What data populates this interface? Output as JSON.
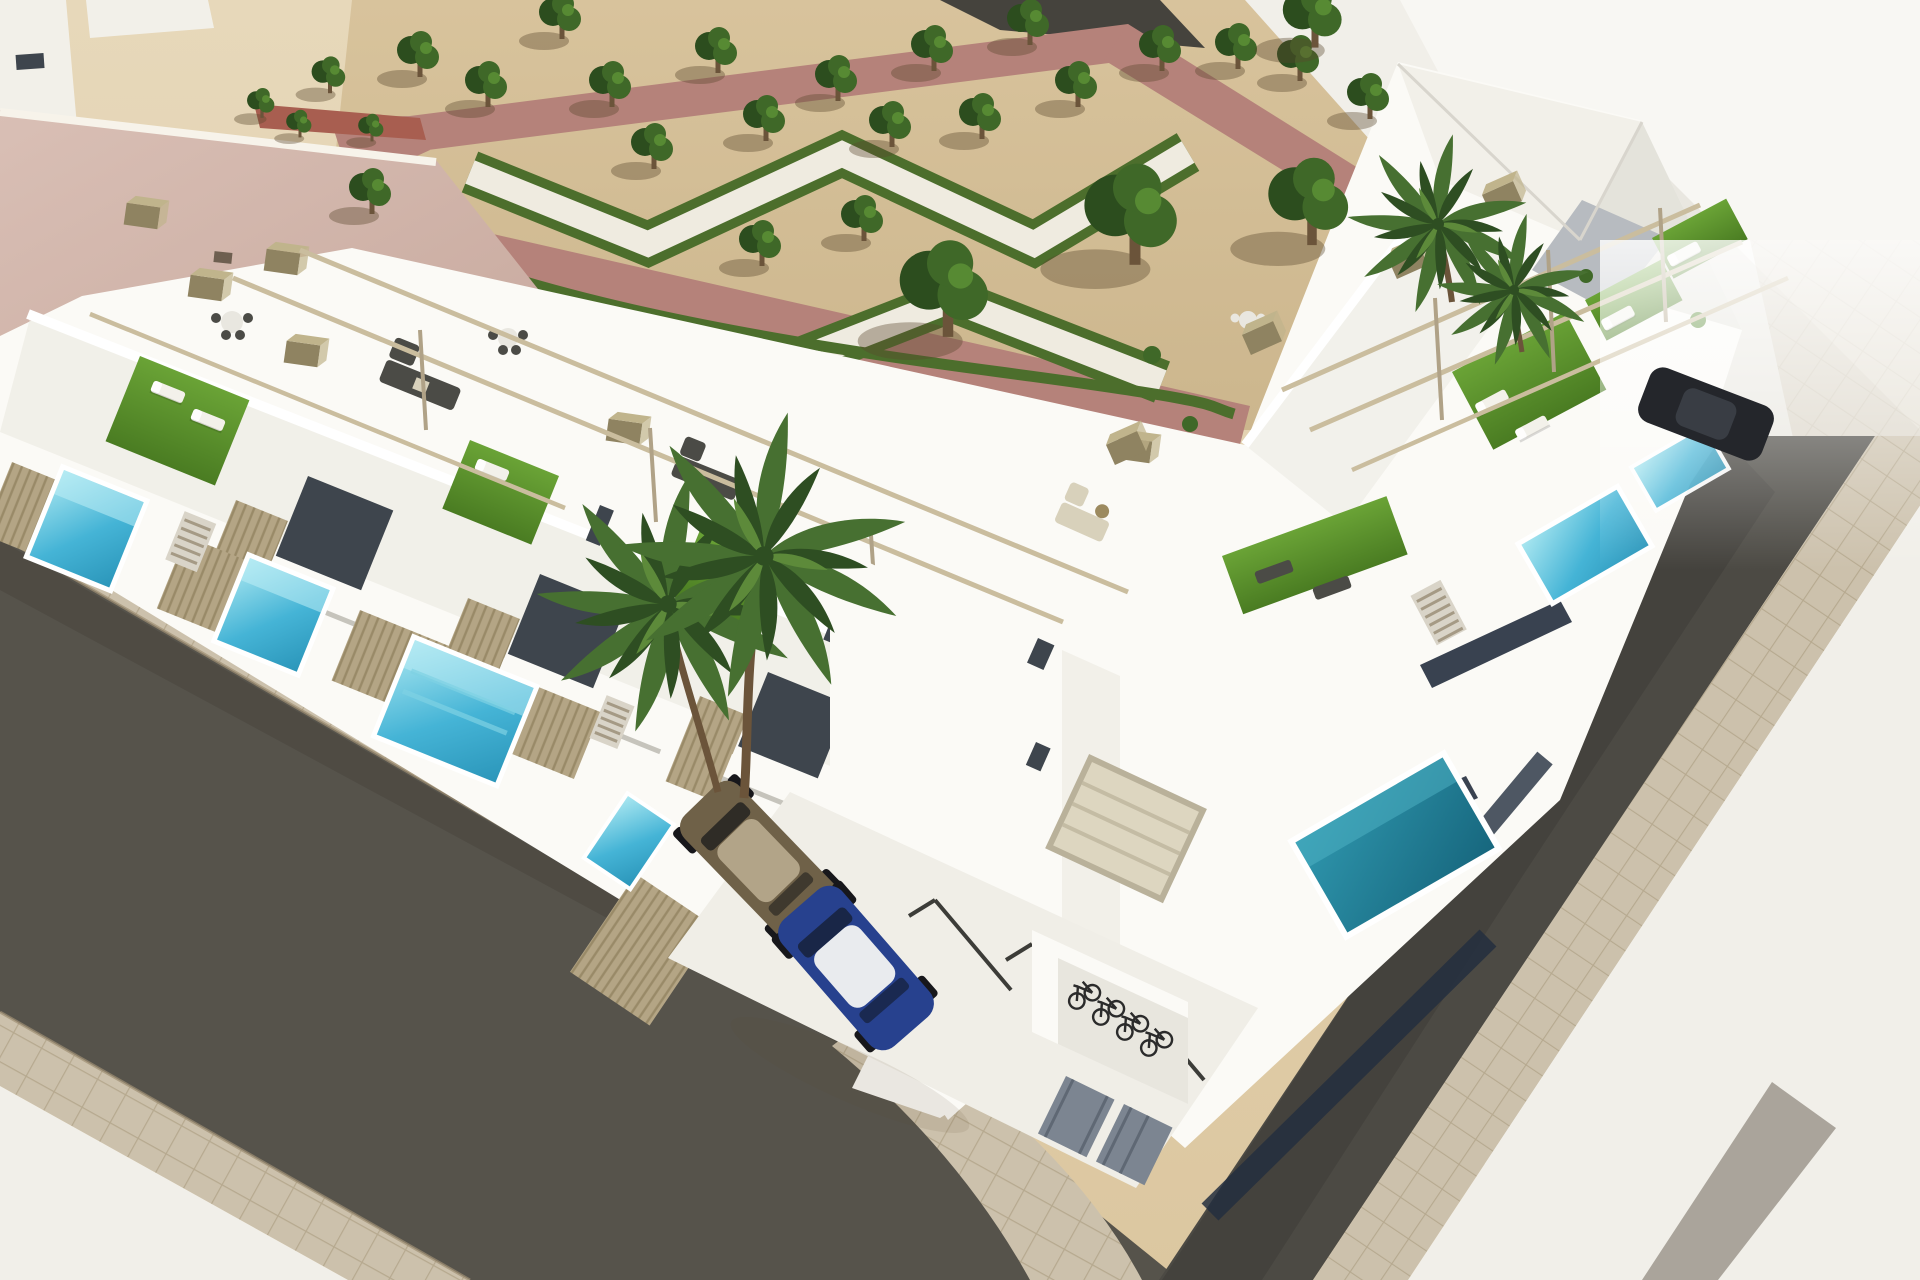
{
  "scene": {
    "title": "Aerial 3D architectural render — modern white corner townhouse development with roof terraces, plunge pools and landscaped park",
    "description": "Bird's-eye visualization of a new-build residential block on a street corner: two rows of white two-storey townhouses with artificial-turf roof terraces, pergola frames and private plunge pools; a sandy public park with clipped zigzag hedges, terracotta walking paths and trees behind; dark asphalt streets with square-slab sidewalks in front; a parking court with two cars, a bicycle shelter with four bikes, and palm trees by the entrance.",
    "setting": "midday sun from the upper right, shadows falling to the lower left",
    "render_style": "photoreal CGI, no text or UI elements visible"
  },
  "palette": {
    "sand": "#e7d8ba",
    "sand_deep": "#dcc7a0",
    "gravel": "#d8c39c",
    "gravel_deep": "#ccb68d",
    "plaza_white": "#f1efe9",
    "plaza_bright": "#f8f7f3",
    "plaza_shadow": "#e5e2db",
    "path_white": "#efebe0",
    "path_red": "#b5827a",
    "path_red_dark": "#a06b62",
    "hedge": "#4c6e2c",
    "hedge_dark": "#3c5a23",
    "tree_dark": "#2c4d1e",
    "tree_mid": "#3f6828",
    "tree_light": "#578a33",
    "trunk": "#6b543a",
    "shadow": "rgba(90,72,45,0.38)",
    "white_wall": "#fbfaf6",
    "white_wall_2": "#f2f0e9",
    "wall_shade": "#dfddd4",
    "wall_dark": "#c6c4bc",
    "terrace_floor": "#e9e7df",
    "roof_pink": "#d9bfb5",
    "roof_pink_dark": "#c7a89d",
    "roof_red": "#a85e50",
    "glass_dark": "#3e454d",
    "navy_glass": "#232e3e",
    "slat_wood": "#b4a585",
    "slat_wood_dark": "#998a68",
    "beam": "#cabd9e",
    "beam_dark": "#b0a287",
    "chimney": "#8f8361",
    "chimney_top": "#c0b48c",
    "turf_hi": "#6aa336",
    "turf_lo": "#4a7c22",
    "pool_hi": "#a8e6f0",
    "pool_mid": "#45b4d6",
    "pool_lo": "#2b96ba",
    "pool_teal_hi": "#2f97ae",
    "pool_teal_lo": "#17677e",
    "asphalt": "#56534b",
    "asphalt_dark": "#4c4a44",
    "sidewalk": "#ccc1ac",
    "sidewalk_line": "#b6a98f",
    "curb": "#9e8f74",
    "lounger_white": "#f3f1ea",
    "sofa_dark": "#4b4b46",
    "sofa_cream": "#d8d1bb",
    "table_white": "#e9e7e0",
    "car_olive": "#6f6148",
    "car_olive_roof": "#b2a488",
    "car_blue": "#27418e",
    "car_blue_dark": "#192647",
    "car_roof_white": "#e9ebee",
    "car_dark": "#24262b",
    "wheel": "#17171b",
    "bike_dark": "#2b2b2b",
    "door_gray": "#7c8591",
    "stripe_gray": "#9d978d",
    "palm_dark": "#2e4e22",
    "palm_mid": "#477031",
    "palm_light": "#5d8a3a"
  },
  "inventory": {
    "buildings": [
      "row of white townhouses with roof terraces facing lower-left street",
      "row of white townhouses facing right street",
      "corner unit with parking court, garage and bicycle shelter",
      "tall showcase building at the top-right street corner",
      "neighbouring building with large pink flat roof, top left",
      "small red-roofed outbuilding at park edge"
    ],
    "landscape": [
      "public park on sand gravel with zigzag white paths bordered by clipped hedges",
      "terracotta pedestrian paths framing the park",
      "21 small park trees and 3 large trees",
      "double palm tree at the residence entrance",
      "two palm trees beside the right-hand terraces"
    ],
    "amenities": [
      "private turquoise plunge pools in the front yards",
      "artificial-turf roof terraces with white sun loungers",
      "rooftop dining sets and dark rattan lounge sets",
      "cream rooftop sofa set on the corner unit",
      "slim pergola frames over the terraces",
      "timber slat privacy fences",
      "bicycle shelter with four bicycles",
      "two grey storage doors"
    ],
    "vehicles": [
      "olive-brown hatchback parked by the fence",
      "blue hatchback with white roof in marked stall",
      "dark car parked on the upper right street"
    ],
    "streets": [
      "asphalt street running lower left",
      "asphalt street running down the right side",
      "square-slab paved sidewalks with rounded corner",
      "white corner plazas with grey inlay stripe"
    ]
  }
}
